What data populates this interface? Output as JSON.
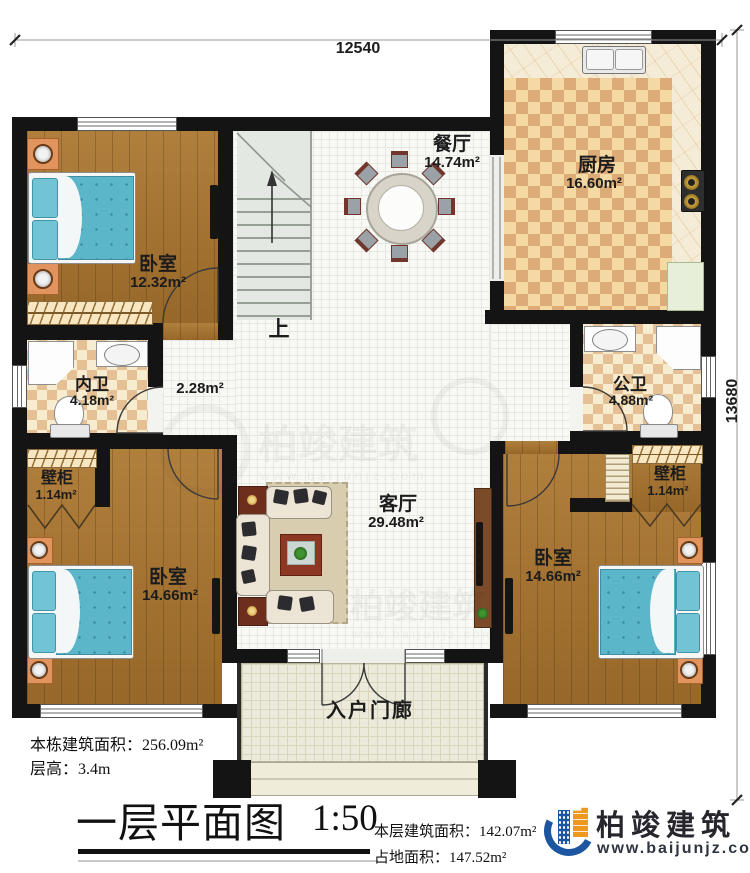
{
  "canvas": {
    "width": 750,
    "height": 873
  },
  "dimensions": {
    "top_width": "12540",
    "right_height": "13680"
  },
  "stairs": {
    "up_label": "上"
  },
  "rooms": {
    "dining": {
      "name": "餐厅",
      "area": "14.74m²"
    },
    "kitchen": {
      "name": "厨房",
      "area": "16.60m²"
    },
    "bedroom_top_left": {
      "name": "卧室",
      "area": "12.32m²"
    },
    "ensuite_bath": {
      "name": "内卫",
      "area": "4.18m²"
    },
    "inner_hall": {
      "area": "2.28m²"
    },
    "public_bath": {
      "name": "公卫",
      "area": "4.88m²"
    },
    "closet_left": {
      "name": "壁柜",
      "area": "1.14m²"
    },
    "closet_right": {
      "name": "壁柜",
      "area": "1.14m²"
    },
    "bedroom_bottom_left": {
      "name": "卧室",
      "area": "14.66m²"
    },
    "bedroom_bottom_right": {
      "name": "卧室",
      "area": "14.66m²"
    },
    "living": {
      "name": "客厅",
      "area": "29.48m²"
    },
    "porch": {
      "name": "入户门廊"
    }
  },
  "annotations": {
    "total_area": "本栋建筑面积：256.09m²",
    "floor_height": "层高：3.4m"
  },
  "title_block": {
    "title": "一层平面图",
    "scale": "1:50",
    "floor_area": "本层建筑面积：142.07m²",
    "footprint_area": "占地面积：147.52m²"
  },
  "brand": {
    "company": "柏竣建筑",
    "website": "www.baijunjz.com",
    "blue": "#1c55a0",
    "orange": "#ef9820"
  },
  "watermark": {
    "text": "柏竣建筑",
    "url": "www.baijunjz.com"
  },
  "colors": {
    "wall": "#141414",
    "wood": "#a8732e",
    "bed_blue": "#5cb6ca",
    "checker": "#dcab77"
  }
}
